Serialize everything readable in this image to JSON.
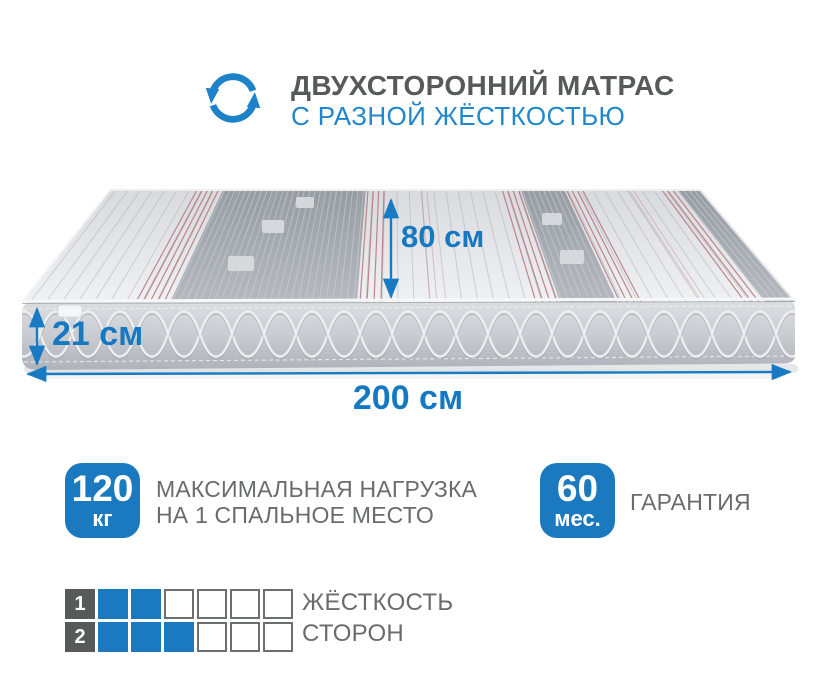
{
  "colors": {
    "accent_blue": "#1b79bf",
    "arrow_blue": "#187ac2",
    "title_gray": "#58595b",
    "text_gray": "#6a6b6d"
  },
  "header": {
    "icon": "two-sided-rotation-arrows",
    "title_line1": "ДВУХСТОРОННИЙ МАТРАС",
    "title_line2": "С РАЗНОЙ ЖЁСТКОСТЬЮ"
  },
  "mattress": {
    "dimension_depth": "80 см",
    "dimension_height": "21 см",
    "dimension_length": "200 см"
  },
  "features": [
    {
      "value": "120",
      "unit": "кг",
      "label_line1": "МАКСИМАЛЬНАЯ НАГРУЗКА",
      "label_line2": "НА 1 СПАЛЬНОЕ МЕСТО"
    },
    {
      "value": "60",
      "unit": "мес.",
      "label_line1": "ГАРАНТИЯ",
      "label_line2": ""
    }
  ],
  "hardness": {
    "label_line1": "ЖЁСТКОСТЬ",
    "label_line2": "СТОРОН",
    "scale_max": 6,
    "rows": [
      {
        "side": "1",
        "level": 2
      },
      {
        "side": "2",
        "level": 3
      }
    ]
  }
}
